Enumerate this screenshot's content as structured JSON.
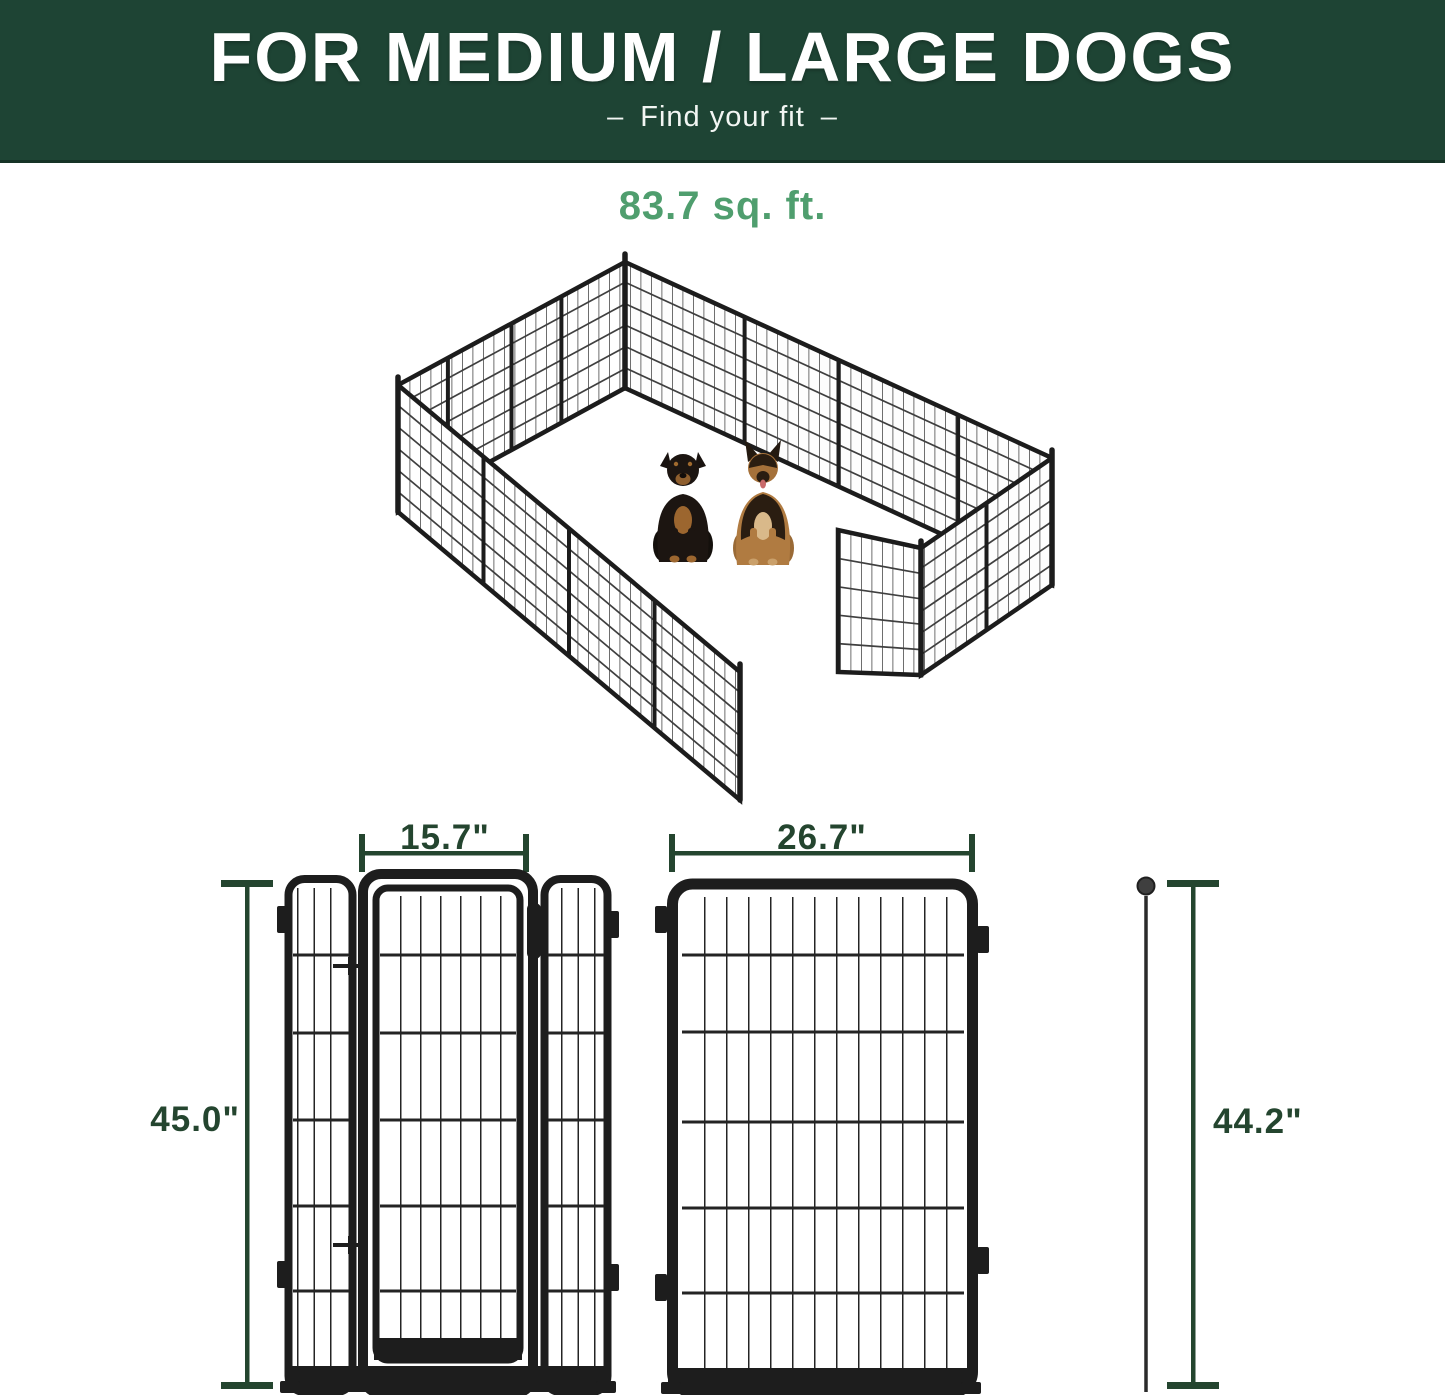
{
  "header": {
    "title": "FOR MEDIUM / LARGE DOGS",
    "dash": "–",
    "subtitle": "Find your fit"
  },
  "area_label": "83.7 sq. ft.",
  "dimensions": {
    "gate_width": "15.7\"",
    "left_height": "45.0\"",
    "panel_width": "26.7\"",
    "stake_height": "44.2\""
  },
  "illustration": {
    "subject": "16-panel metal dog playpen with open gate",
    "dogs": [
      "rottweiler",
      "german-shepherd"
    ]
  },
  "colors": {
    "header_bg": "#1e4434",
    "accent_green": "#4f9e6e",
    "dimension_green": "#24452f",
    "fence_black": "#1d1d1d"
  }
}
